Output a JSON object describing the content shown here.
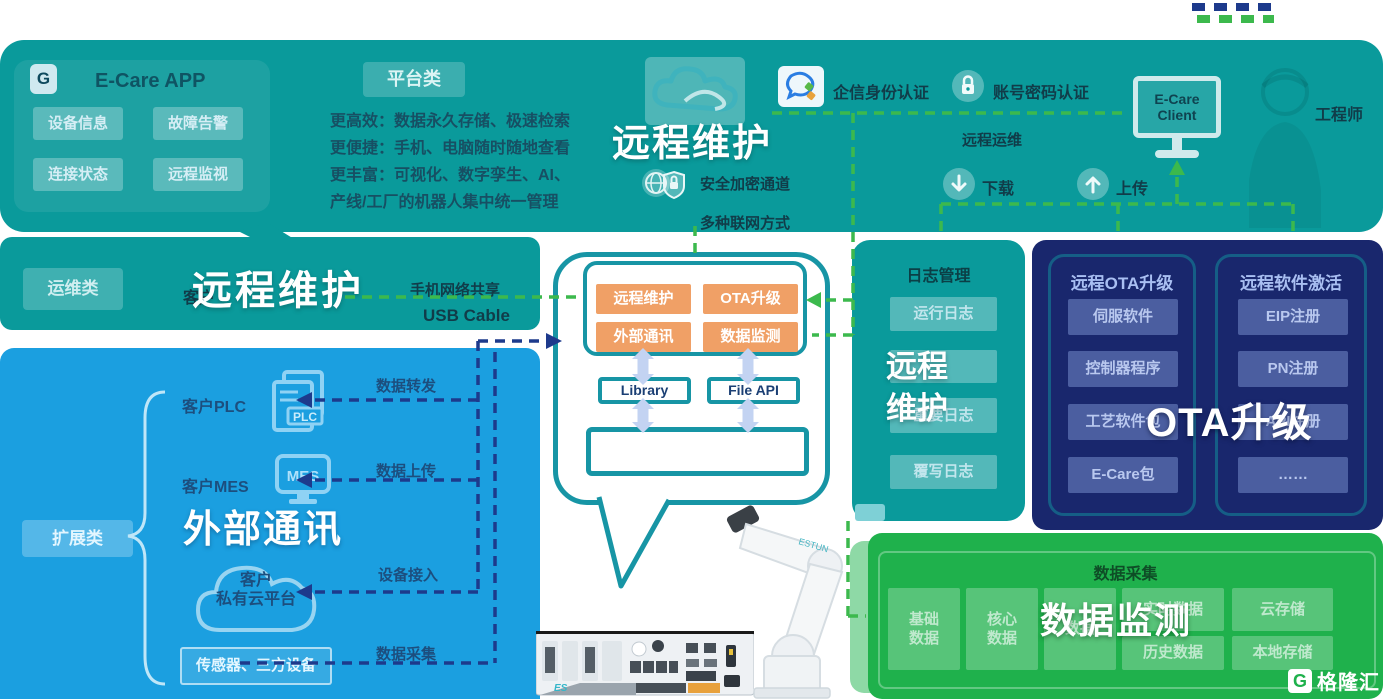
{
  "banner": {
    "ecare": {
      "title": "E-Care APP",
      "icon_glyph": "G",
      "buttons": [
        "设备信息",
        "故障告警",
        "连接状态",
        "远程监视"
      ]
    },
    "platform": {
      "badge": "平台类",
      "lines": [
        "更高效：数据永久存储、极速检索",
        "更便捷：手机、电脑随时随地查看",
        "更丰富：可视化、数字孪生、AI、",
        "产线/工厂的机器人集中统一管理"
      ]
    },
    "main_title": "远程维护",
    "secure_channel": "安全加密通道",
    "network_modes": "多种联网方式",
    "auth_wechat": "企信身份认证",
    "auth_password": "账号密码认证",
    "remote_ops": "远程运维",
    "download": "下载",
    "upload": "上传",
    "client": "E-Care Client",
    "engineer": "工程师"
  },
  "ops_band": {
    "badge": "运维类",
    "customer": "客户",
    "title": "远程维护",
    "phone_share": "手机网络共享",
    "usb": "USB Cable"
  },
  "ext_panel": {
    "badge": "扩展类",
    "plc_label": "客户PLC",
    "plc_icon_text": "PLC",
    "mes_label": "客户MES",
    "mes_icon_text": "MES",
    "title": "外部通讯",
    "cloud_line1": "客户",
    "cloud_line2": "私有云平台",
    "sensors": "传感器、三方设备",
    "flows": [
      "数据转发",
      "数据上传",
      "设备接入",
      "数据采集"
    ]
  },
  "bubble": {
    "modules": [
      "远程维护",
      "OTA升级",
      "外部通讯",
      "数据监测"
    ],
    "library": "Library",
    "file_api": "File API"
  },
  "log_panel": {
    "header": "日志管理",
    "buttons": [
      "运行日志",
      "",
      "重要日志",
      "覆写日志"
    ],
    "overlay_line1": "远程",
    "overlay_line2": "维护"
  },
  "ota_panel": {
    "overlay": "OTA升级",
    "columns": [
      {
        "header": "远程OTA升级",
        "items": [
          "伺服软件",
          "控制器程序",
          "工艺软件包",
          "E-Care包"
        ]
      },
      {
        "header": "远程软件激活",
        "items": [
          "EIP注册",
          "PN注册",
          "API注册",
          "……"
        ]
      }
    ]
  },
  "data_panel": {
    "header": "数据采集",
    "overlay": "数据监测",
    "squares": [
      "基础数据",
      "核心数据",
      "数据"
    ],
    "boxes": [
      "实时数据",
      "云存储",
      "历史数据",
      "本地存储"
    ]
  },
  "watermark": {
    "logo_glyph": "G",
    "logo_text": "格隆汇"
  },
  "colors": {
    "teal": "#0a9a9b",
    "blue": "#1b9fe0",
    "navy": "#19276d",
    "green": "#1fb14c",
    "orange": "#f0a066",
    "dash_green": "#3cb94d",
    "dash_navy": "#1d3a8c",
    "bubble_border": "#1795a5",
    "offset_green": "#8ed9a6"
  }
}
